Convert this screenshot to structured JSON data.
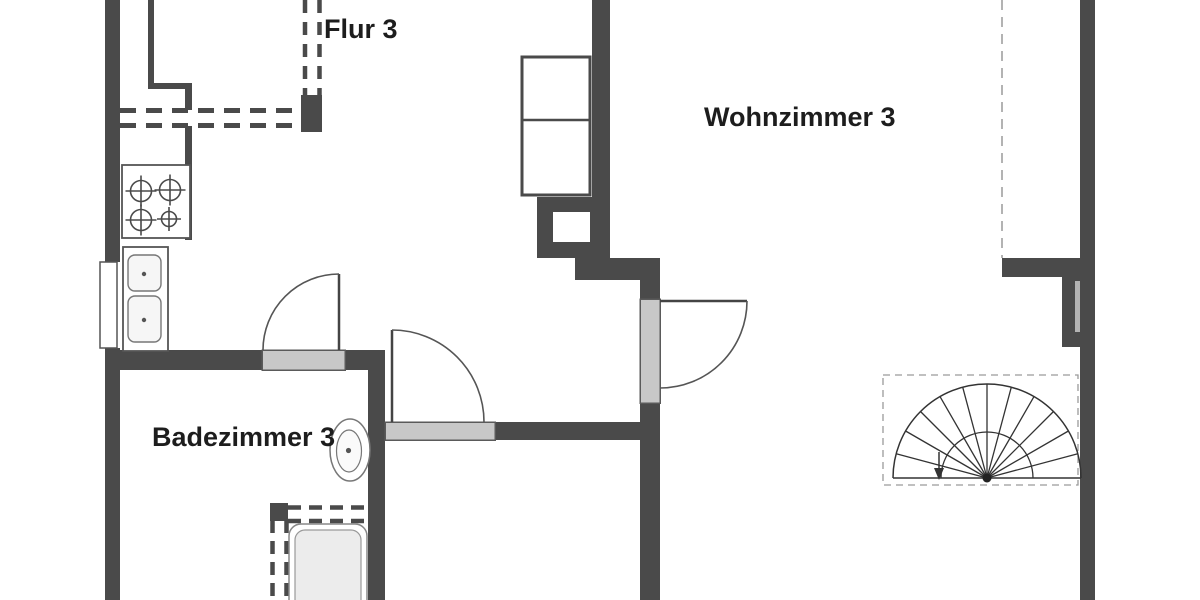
{
  "plan": {
    "rooms": [
      {
        "id": "flur",
        "label": "Flur 3"
      },
      {
        "id": "wohnzimmer",
        "label": "Wohnzimmer 3"
      },
      {
        "id": "badezimmer",
        "label": "Badezimmer 3"
      }
    ],
    "fixtures": [
      "stove-4-burner-icon",
      "kitchen-double-sink-icon",
      "window-icon",
      "toilet-icon",
      "bathtub-icon",
      "cupboard-icon",
      "chimney-shaft-icon",
      "spiral-staircase-icon",
      "door-swing-icon"
    ],
    "colors": {
      "wall": "#4a4a4a",
      "door_sill": "#c8c8c8",
      "background": "#ffffff",
      "fixture_line": "#555555",
      "stair_line": "#333333",
      "dashed_guide": "#9a9a9a",
      "tub_fill": "#ececec",
      "text": "#1d1d1d"
    }
  }
}
